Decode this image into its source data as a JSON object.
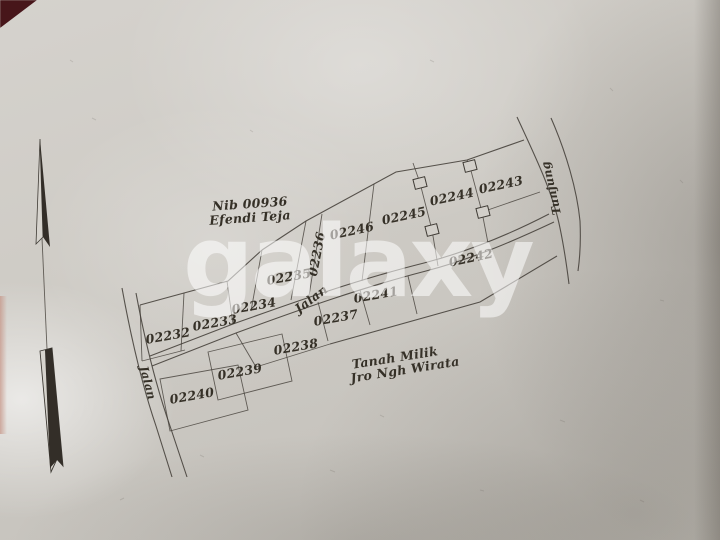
{
  "watermark": {
    "text": "galaxy",
    "color": "#ffffff"
  },
  "paper": {
    "base_color": "#cecbc5",
    "ink_color": "#45403a",
    "corner_object_color": "#47161a"
  },
  "map": {
    "owner_note": {
      "line1": "Nib 00936",
      "line2": "Efendi Teja"
    },
    "neighbor_note": {
      "line1": "Tanah Milik",
      "line2": "Jro Ngh Wirata"
    },
    "roads": {
      "center_label": "Jalan",
      "left_label": "Jalan",
      "right_label": "Tunjung"
    },
    "compass": {
      "icon": "north-arrow"
    },
    "parcels": [
      {
        "id": "02232"
      },
      {
        "id": "02233"
      },
      {
        "id": "02234"
      },
      {
        "id": "02235"
      },
      {
        "id": "02236"
      },
      {
        "id": "02237"
      },
      {
        "id": "02238"
      },
      {
        "id": "02239"
      },
      {
        "id": "02240"
      },
      {
        "id": "02241"
      },
      {
        "id": "02242"
      },
      {
        "id": "02243"
      },
      {
        "id": "02244"
      },
      {
        "id": "02245"
      },
      {
        "id": "02246"
      }
    ]
  }
}
